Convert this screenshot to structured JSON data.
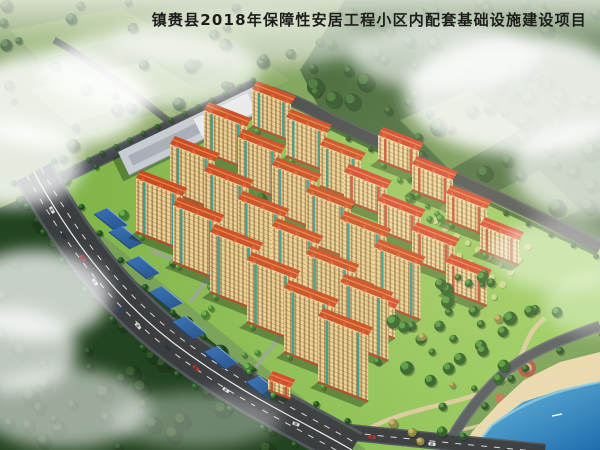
{
  "title": {
    "text": "镇赉县2018年保障性安居工程小区内配套基础设施建设项目"
  },
  "scene": {
    "kind": "aerial-architectural-rendering",
    "palette": {
      "base_green": "#79a258",
      "farmland": "#7c9c5c",
      "forest_dark": "#2c5129",
      "forest_bottom": "#234420",
      "site_grass": "#85bd4f",
      "site_grass_light": "#9ccf63",
      "road_asphalt": "#3a3e41",
      "road_edge": "#53585c",
      "road_line": "#ffffff",
      "facade_tall": "#ecd193",
      "facade_mid": "#f2dba0",
      "window": "#5e3f1d",
      "roof_tall": "#c7481f",
      "roof_mid": "#d2402a",
      "roof_ridge": "#ef8040",
      "accent_teal": "#2d948a",
      "accent_red": "#c8432b",
      "base_band": "#aa4c28",
      "canopy_blue": "#2e62a4",
      "gray_building": "#c7ccd3",
      "water_deep": "#1f6dae",
      "water_light": "#5db4de",
      "beach": "#ead9ae",
      "beach_accent": "#b65a44",
      "path_tan": "#ddcba1",
      "pond_teal": "#3b7e8e",
      "orchard_tree": "#c6d687",
      "mist": "#ffffff",
      "title_color": "#1d1d1b"
    },
    "towers": [
      [
        136,
        232,
        50,
        54
      ],
      [
        173,
        262,
        50,
        57
      ],
      [
        210,
        292,
        52,
        60
      ],
      [
        247,
        322,
        52,
        62
      ],
      [
        284,
        352,
        54,
        64
      ],
      [
        318,
        382,
        54,
        66
      ],
      [
        170,
        192,
        48,
        48
      ],
      [
        204,
        222,
        48,
        51
      ],
      [
        238,
        252,
        50,
        53
      ],
      [
        272,
        282,
        50,
        56
      ],
      [
        306,
        312,
        52,
        58
      ],
      [
        340,
        342,
        52,
        60
      ],
      [
        204,
        152,
        46,
        42
      ],
      [
        238,
        182,
        46,
        45
      ],
      [
        272,
        212,
        48,
        47
      ],
      [
        306,
        242,
        48,
        50
      ],
      [
        340,
        272,
        50,
        53
      ],
      [
        374,
        302,
        50,
        55
      ],
      [
        252,
        126,
        42,
        37
      ],
      [
        286,
        156,
        44,
        39
      ],
      [
        320,
        186,
        44,
        41
      ]
    ],
    "mid_rise": [
      [
        344,
        200,
        46,
        28
      ],
      [
        378,
        230,
        46,
        29
      ],
      [
        412,
        260,
        46,
        30
      ],
      [
        446,
        290,
        44,
        28
      ],
      [
        378,
        160,
        44,
        25
      ],
      [
        412,
        190,
        44,
        26
      ],
      [
        446,
        220,
        44,
        27
      ],
      [
        480,
        250,
        42,
        25
      ],
      [
        352,
        322,
        46,
        30
      ]
    ],
    "kindergarten": [
      268,
      390,
      24,
      11
    ],
    "canopies": [
      [
        94,
        214
      ],
      [
        109,
        232
      ],
      [
        126,
        262
      ],
      [
        149,
        292
      ],
      [
        172,
        322
      ],
      [
        204,
        352
      ],
      [
        246,
        382
      ]
    ],
    "cars": [
      [
        52,
        210,
        62,
        "#e8e8e8"
      ],
      [
        64,
        236,
        60,
        "#30343a"
      ],
      [
        83,
        258,
        56,
        "#b8342a"
      ],
      [
        95,
        282,
        54,
        "#e0e0e6"
      ],
      [
        120,
        310,
        50,
        "#2c3e74"
      ],
      [
        138,
        326,
        48,
        "#d8d8d8"
      ],
      [
        168,
        348,
        42,
        "#2f3338"
      ],
      [
        196,
        368,
        38,
        "#c22f28"
      ],
      [
        226,
        390,
        33,
        "#e4e4e8"
      ],
      [
        258,
        408,
        28,
        "#33373c"
      ],
      [
        296,
        424,
        20,
        "#dcdcdc"
      ],
      [
        372,
        437,
        7,
        "#b8342a"
      ],
      [
        432,
        444,
        6,
        "#e8e8ea"
      ]
    ],
    "ponds": [
      [
        255,
        215,
        13,
        6
      ],
      [
        310,
        262,
        10,
        5
      ]
    ],
    "boat": [
      552,
      416
    ]
  }
}
